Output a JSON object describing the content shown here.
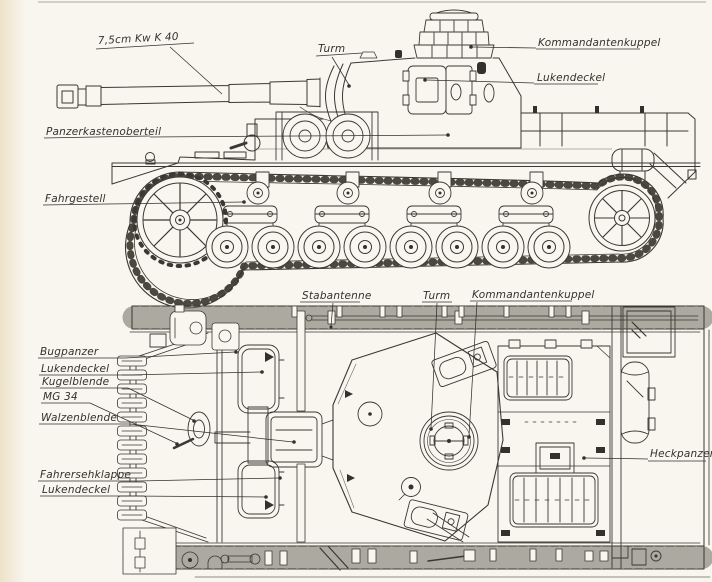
{
  "colors": {
    "paper": "#f8f6ef",
    "ink": "#3a3832",
    "ink_soft": "#6e6a5e"
  },
  "side_view": {
    "labels": {
      "gun": "7,5cm Kw K 40",
      "turret": "Turm",
      "cupola": "Kommandantenkuppel",
      "hatch": "Lukendeckel",
      "upper_hull": "Panzerkastenoberteil",
      "chassis": "Fahrgestell"
    }
  },
  "top_view": {
    "labels": {
      "antenna": "Stabantenne",
      "turret": "Turm",
      "cupola": "Kommandantenkuppel",
      "bow_armor": "Bugpanzer",
      "bow_hatch": "Lukendeckel",
      "ball_mount": "Kugelblende",
      "machine_gun": "MG 34",
      "gun_mantlet": "Walzenblende",
      "driver_visor": "Fahrersehklappe",
      "driver_hatch": "Lukendeckel",
      "rear_armor": "Heckpanzer"
    }
  }
}
